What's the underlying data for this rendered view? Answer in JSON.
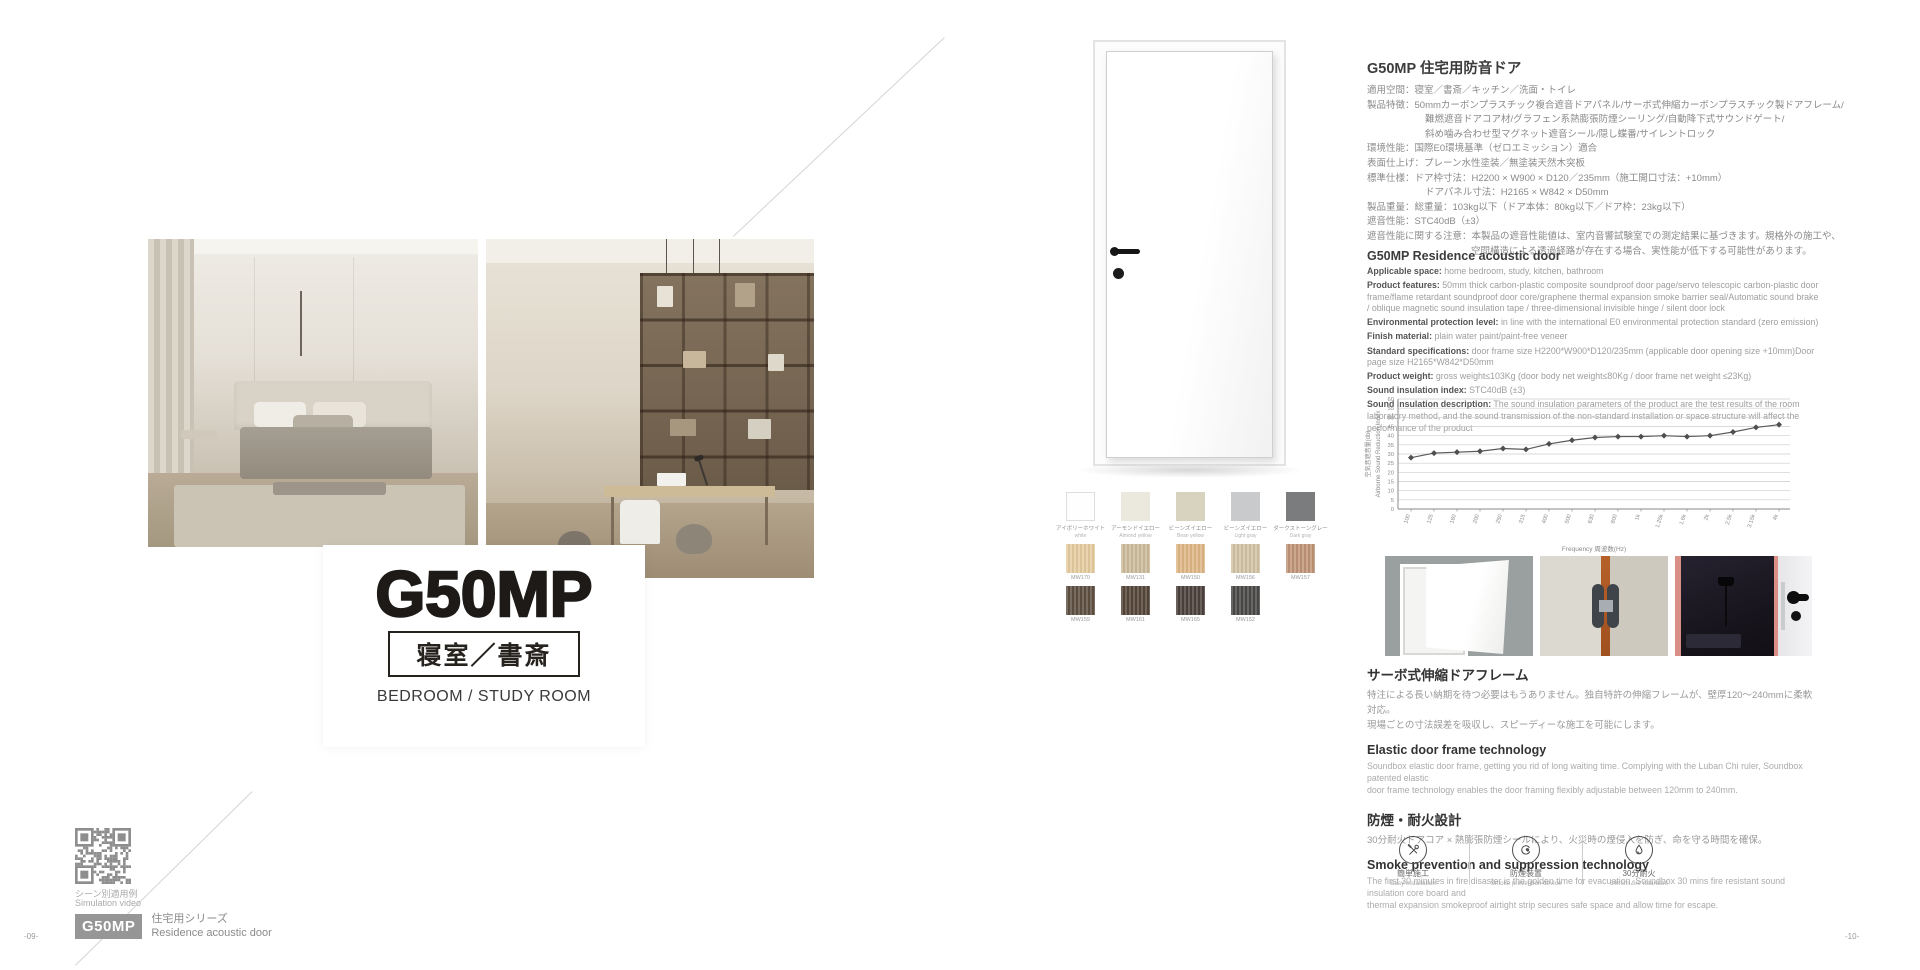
{
  "page_left": {
    "title": "G50MP",
    "subtitle_jp": "寝室／書斎",
    "subtitle_en": "BEDROOM / STUDY ROOM",
    "qr_caption_jp": "シーン別適用例",
    "qr_caption_en": "Simulation video",
    "series_code": "G50MP",
    "series_name_jp": "住宅用シリーズ",
    "series_name_en": "Residence acoustic door",
    "page_number": "-09-"
  },
  "page_right": {
    "page_number": "-10-",
    "specs_jp": {
      "heading": "G50MP 住宅用防音ドア",
      "lines": [
        {
          "indent": 0,
          "text": "適用空間：寝室／書斎／キッチン／洗面・トイレ"
        },
        {
          "indent": 0,
          "text": "製品特徴：50mmカーボンプラスチック複合遮音ドアパネル/サーボ式伸縮カーボンプラスチック製ドアフレーム/"
        },
        {
          "indent": 1,
          "text": "難燃遮音ドアコア材/グラフェン系熱膨張防煙シーリング/自動降下式サウンドゲート/"
        },
        {
          "indent": 1,
          "text": "斜め噛み合わせ型マグネット遮音シール/隠し蝶番/サイレントロック"
        },
        {
          "indent": 0,
          "text": "環境性能：国際E0環境基準（ゼロエミッション）適合"
        },
        {
          "indent": 0,
          "text": "表面仕上げ：プレーン水性塗装／無塗装天然木突板"
        },
        {
          "indent": 0,
          "text": "標準仕様：ドア枠寸法：H2200 × W900 × D120／235mm（施工開口寸法：+10mm）"
        },
        {
          "indent": 1,
          "text": "ドアパネル寸法：H2165 × W842 × D50mm"
        },
        {
          "indent": 0,
          "text": "製品重量：総重量：103kg以下（ドア本体：80kg以下／ドア枠：23kg以下）"
        },
        {
          "indent": 0,
          "text": "遮音性能：STC40dB（±3）"
        },
        {
          "indent": 0,
          "text": "遮音性能に関する注意：本製品の遮音性能値は、室内音響試験室での測定結果に基づきます。規格外の施工や、"
        },
        {
          "indent": 2,
          "text": "空間構造による透過経路が存在する場合、実性能が低下する可能性があります。"
        }
      ]
    },
    "specs_en": {
      "heading": "G50MP Residence acoustic door",
      "items": [
        {
          "label": "Applicable space:",
          "text": "home bedroom, study, kitchen, bathroom"
        },
        {
          "label": "Product features:",
          "text": "50mm thick carbon-plastic composite soundproof door page/servo telescopic carbon-plastic door frame/flame retardant soundproof door core/graphene thermal expansion smoke barrier seal/Automatic sound brake / oblique magnetic sound insulation tape / three-dimensional invisible hinge / silent door lock"
        },
        {
          "label": "Environmental protection level:",
          "text": "in line with the international E0 environmental protection standard (zero emission)"
        },
        {
          "label": "Finish material:",
          "text": "plain water paint/paint-free veneer"
        },
        {
          "label": "Standard specifications:",
          "text": "door frame size H2200*W900*D120/235mm (applicable door opening size +10mm)Door page size H2165*W842*D50mm"
        },
        {
          "label": "Product weight:",
          "text": "gross weight≤103Kg (door body net weight≤80Kg / door frame net weight ≤23Kg)"
        },
        {
          "label": "Sound insulation index:",
          "text": "STC40dB (±3)"
        },
        {
          "label": "Sound insulation description:",
          "text": "The sound insulation parameters of the product are the test results of the room laboratory method, and the sound transmission of the non-standard installation or space structure will affect the performance of the product"
        }
      ]
    },
    "swatches": {
      "rows": [
        {
          "items": [
            {
              "name_jp": "アイボリーホワイト",
              "name_en": "white",
              "color": "#fefefe",
              "border": true
            },
            {
              "name_jp": "アーモンドイエロー",
              "name_en": "Almond yellow",
              "color": "#ebe8dd"
            },
            {
              "name_jp": "ビーンズイエロー",
              "name_en": "Bean yellow",
              "color": "#d7d3bf"
            },
            {
              "name_jp": "ビーンズイエロー",
              "name_en": "Light gray",
              "color": "#c8cacc"
            },
            {
              "name_jp": "ダークストーングレー",
              "name_en": "Dark gray",
              "color": "#7a7c7d"
            }
          ]
        },
        {
          "items": [
            {
              "code": "MW170",
              "color": "#e6cda1"
            },
            {
              "code": "MW131",
              "color": "#cdbc9b"
            },
            {
              "code": "MW150",
              "color": "#e0b887"
            },
            {
              "code": "MW156",
              "color": "#d3c4a5"
            },
            {
              "code": "MW157",
              "color": "#c19677"
            }
          ]
        },
        {
          "items": [
            {
              "code": "MW159",
              "color": "#5f5143"
            },
            {
              "code": "MW161",
              "color": "#56473a"
            },
            {
              "code": "MW165",
              "color": "#4d423d"
            },
            {
              "code": "MW152",
              "color": "#4b4a49"
            }
          ]
        }
      ]
    },
    "sections": [
      {
        "lang": "jp",
        "heading": "サーボ式伸縮ドアフレーム",
        "body": "特注による長い納期を待つ必要はもうありません。独自特許の伸縮フレームが、壁厚120～240mmに柔軟対応。\n現場ごとの寸法誤差を吸収し、スピーディーな施工を可能にします。"
      },
      {
        "lang": "en",
        "heading": "Elastic door frame technology",
        "body": "Soundbox elastic door frame, getting you rid of long waiting time. Complying with the Luban Chi ruler, Soundbox patented elastic\ndoor frame technology enables the door framing flexibly adjustable between 120mm to 240mm."
      },
      {
        "lang": "jp",
        "heading": "防煙・耐火設計",
        "body": "30分耐火ドアコア × 熱膨張防煙シールにより、火災時の煙侵入を防ぎ、命を守る時間を確保。"
      },
      {
        "lang": "en",
        "heading": "Smoke prevention and suppression technology",
        "body": "The first 30 minutes in fire disaster is the golden time for evacuation, Soundbox 30 mins fire resistant sound insulation core board and\nthermal expansion smokeproof airtight strip secures safe space and allow time for escape."
      }
    ],
    "feature_icons": [
      {
        "icon": "tools-icon",
        "label_jp": "簡単施工",
        "label_en": "Easy installation"
      },
      {
        "icon": "smoke-device-icon",
        "label_jp": "防煙装置",
        "label_en": "Smoke prevention device"
      },
      {
        "icon": "flame-icon",
        "label_jp": "30分耐火",
        "label_en": "30mins fire retardant"
      }
    ]
  },
  "chart_data": {
    "type": "line",
    "x": [
      "100",
      "125",
      "160",
      "200",
      "250",
      "315",
      "400",
      "500",
      "630",
      "800",
      "1k",
      "1.25k",
      "1.6k",
      "2k",
      "2.5k",
      "3.15k",
      "4k"
    ],
    "values": [
      28,
      30.5,
      31,
      31.5,
      33,
      32.5,
      35.5,
      37.5,
      39,
      39.5,
      39.5,
      40,
      39.5,
      40,
      42,
      44.5,
      46
    ],
    "title": "",
    "xlabel": "Frequency 周波数(Hz)",
    "ylabel_jp": "空気音遮音量(db)",
    "ylabel_en": "Airborne Sound Reduction Index",
    "ylim": [
      0,
      60
    ],
    "ytick_step": 5,
    "grid": true,
    "legend": "none",
    "line_color": "#5a5a5a"
  }
}
